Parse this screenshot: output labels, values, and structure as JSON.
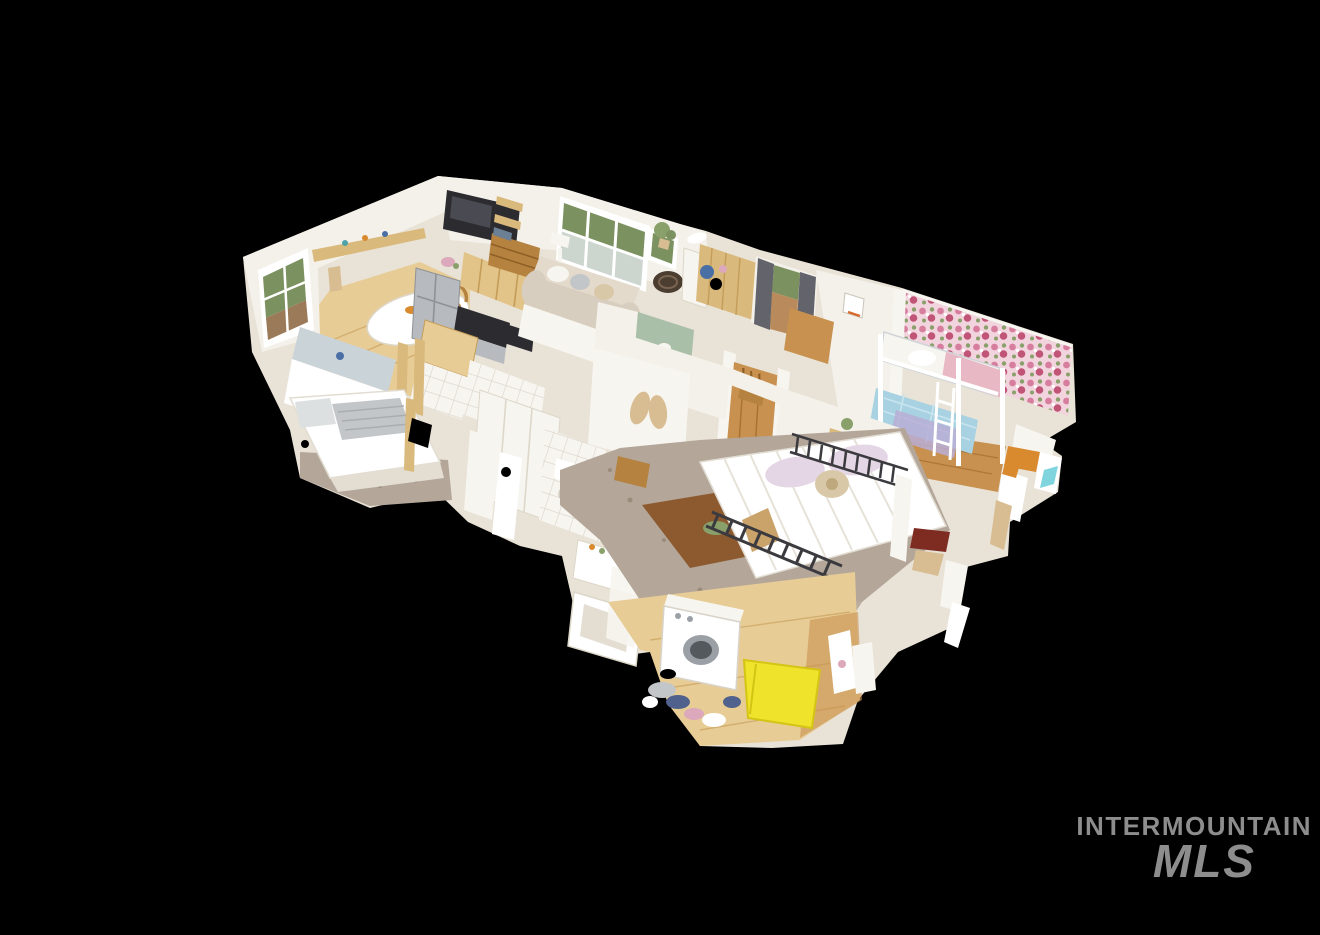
{
  "scene": {
    "type": "3d-dollhouse-cutaway",
    "description": "Matterport-style 3D dollhouse cutaway scan of a single-story home floating on a black background, viewed from above at an angle; mesh edges are ragged where the scan is incomplete",
    "background_color": "#000000",
    "rooms": [
      {
        "name": "living-room",
        "visible_items": [
          "wall-mounted flat TV",
          "beige sofa with throw pillows",
          "large triple window with greenery view",
          "wood dresser",
          "ladder shelf",
          "potted plant",
          "round jute hat on half wall",
          "floor lamp"
        ]
      },
      {
        "name": "kitchen",
        "visible_items": [
          "stainless refrigerator",
          "range with dark cooktop",
          "light wood upper cabinets",
          "butcher-block island",
          "white tile",
          "steel-blue sink counter",
          "pink flowers"
        ]
      },
      {
        "name": "dining-nook",
        "visible_items": [
          "round table with white tablecloth",
          "window with backyard and fence view",
          "wood wall shelf with bottles"
        ]
      },
      {
        "name": "left-bedroom",
        "visible_items": [
          "bed with white duvet and gray striped blanket",
          "mottled tan carpet",
          "teal towel on post"
        ]
      },
      {
        "name": "entry-hall",
        "visible_items": [
          "tan wood-paneled wall",
          "blue coats on hooks",
          "window with dark gray curtains",
          "wood step chest",
          "small basketball hoop",
          "white dish on wall top"
        ]
      },
      {
        "name": "kids-bedroom",
        "visible_items": [
          "pink floral wallpaper",
          "white metal bunk bed",
          "light blue quilt on lower bunk",
          "pink blanket on upper bunk",
          "purple floral quilt",
          "hardwood floor"
        ]
      },
      {
        "name": "hallway",
        "visible_items": [
          "warm hardwood floor",
          "wooden chair",
          "white door casings"
        ]
      },
      {
        "name": "bathroom",
        "visible_items": [
          "white bathtub",
          "toilet",
          "white vanity",
          "sage green accent wall",
          "angel wings wall decor",
          "white tile wall"
        ]
      },
      {
        "name": "master-bedroom",
        "visible_items": [
          "black iron frame bed",
          "white striped duvet",
          "lavender pillows",
          "beaded accent pillow",
          "gray-taupe carpet",
          "wood rug inlay",
          "wood nightstand",
          "wall shelf with plant"
        ]
      },
      {
        "name": "laundry-room",
        "visible_items": [
          "white front-load washer",
          "scattered laundry clothes",
          "bright yellow mat",
          "light oak floor",
          "torn white mesh fragments"
        ]
      }
    ],
    "palette": {
      "bg": "#000000",
      "base": "#e9e2d6",
      "wall": "#f4f1ea",
      "wallShade": "#e4ded2",
      "offWhite": "#f7f5f0",
      "white": "#ffffff",
      "woodFloor": "#c8914f",
      "woodDark": "#a96f33",
      "woodLight": "#e8cc96",
      "cabinet": "#e2c488",
      "panelWood": "#d9b97c",
      "dresser": "#b5823f",
      "stainless": "#b7bbbf",
      "tv": "#2b2b30",
      "sofa": "#d8cec0",
      "sofaBack": "#e3dacb",
      "green": "#7c9160",
      "porch": "#cdd5cf",
      "fence": "#9a7a58",
      "curtain": "#62636b",
      "floralBase": "#f2d4de",
      "rose": "#d77e9f",
      "roseDeep": "#c15577",
      "leafGreen": "#8aa06b",
      "bunkBlue": "#a8d2e2",
      "quilt": "#b8aed6",
      "pinkBlanket": "#e8b8c4",
      "carpet": "#b4a79a",
      "carpetDark": "#9a8b7b",
      "lavender": "#e4d6e4",
      "pillowBead": "#d9c8a8",
      "metal": "#3b3a3e",
      "sage": "#a9bfa7",
      "wing": "#d9bd92",
      "rugBrown": "#8c5a2e",
      "yellow": "#efe32b",
      "teal": "#4fa3a8",
      "blue": "#4a6fa5",
      "clothNavy": "#4f618c",
      "clothPink": "#dba8bc",
      "clothGray": "#c3c6c9",
      "maroon": "#7e2c22",
      "amber": "#d98a2e",
      "steelBlue": "#c9d3d8",
      "hat": "#4c3d31",
      "watermark": "#8d8d8d"
    }
  },
  "watermark": {
    "line1": "INTERMOUNTAIN",
    "line2": "MLS",
    "color": "#8d8d8d"
  }
}
